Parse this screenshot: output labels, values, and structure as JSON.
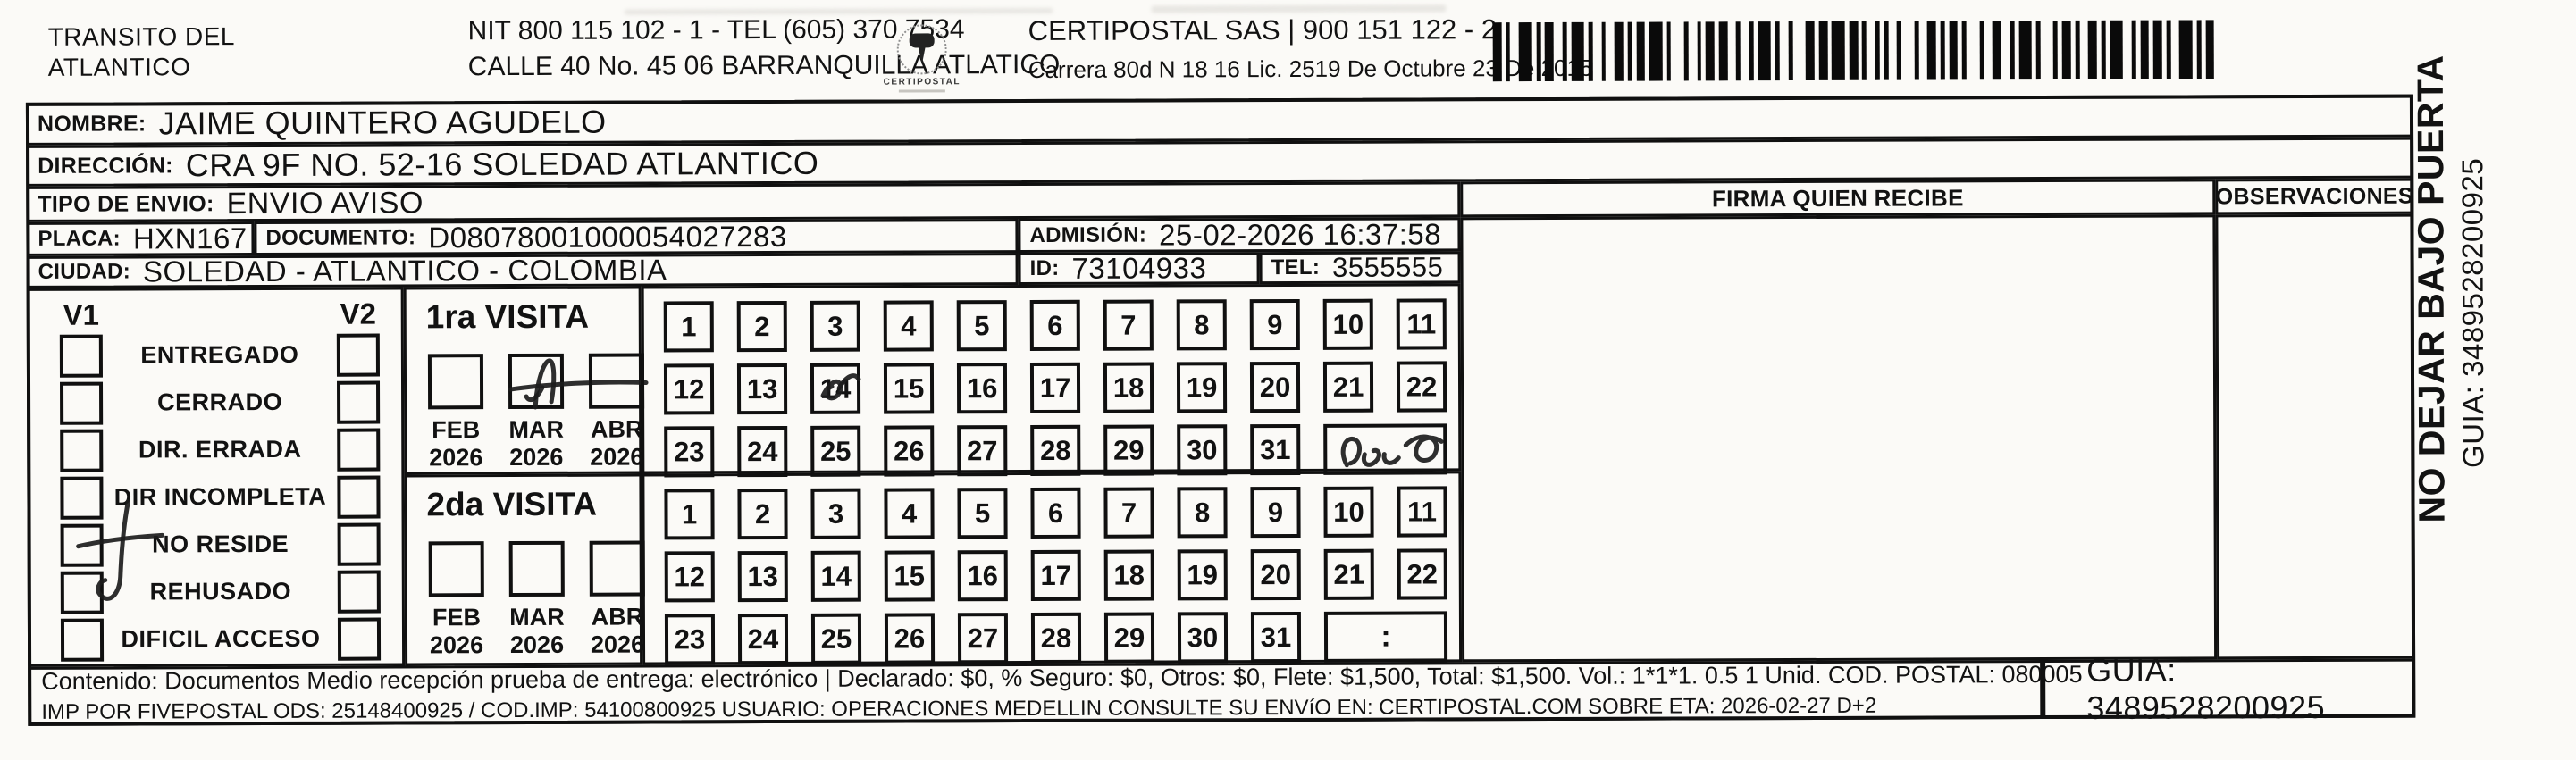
{
  "header": {
    "company_line1": "TRANSITO DEL",
    "company_line2": "ATLANTICO",
    "nit_line": "NIT 800 115 102 - 1 - TEL (605) 370 7534",
    "address_line": "CALLE 40 No. 45 06 BARRANQUILLA ATLATICO",
    "logo_caption": "CERTIPOSTAL",
    "certipostal_line": "CERTIPOSTAL SAS | 900 151 122 - 2",
    "certipostal_address": "Carrera 80d N 18 16  Lic. 2519 De Octubre 23 De 2015"
  },
  "recipient": {
    "nombre_label": "NOMBRE:",
    "nombre": "JAIME QUINTERO AGUDELO",
    "direccion_label": "DIRECCIÓN:",
    "direccion": "CRA 9F NO. 52-16 SOLEDAD ATLANTICO",
    "tipo_label": "TIPO DE ENVIO:",
    "tipo": "ENVIO AVISO",
    "placa_label": "PLACA:",
    "placa": "HXN167",
    "documento_label": "DOCUMENTO:",
    "documento": "D08078001000054027283",
    "admision_label": "ADMISIÓN:",
    "admision": "25-02-2026 16:37:58",
    "ciudad_label": "CIUDAD:",
    "ciudad": "SOLEDAD - ATLANTICO - COLOMBIA",
    "id_label": "ID:",
    "id": "73104933",
    "tel_label": "TEL:",
    "tel": "3555555"
  },
  "signature": {
    "firma_header": "FIRMA QUIEN RECIBE",
    "observaciones_header": "OBSERVACIONES"
  },
  "visits": {
    "v1_label": "V1",
    "v2_label": "V2",
    "status_options": [
      "ENTREGADO",
      "CERRADO",
      "DIR. ERRADA",
      "DIR INCOMPLETA",
      "NO RESIDE",
      "REHUSADO",
      "DIFICIL ACCESO"
    ],
    "first_visit_label": "1ra VISITA",
    "second_visit_label": "2da VISITA",
    "months": [
      {
        "month": "FEB",
        "year": "2026"
      },
      {
        "month": "MAR",
        "year": "2026"
      },
      {
        "month": "ABR",
        "year": "2026"
      }
    ],
    "days_row1": [
      1,
      2,
      3,
      4,
      5,
      6,
      7,
      8,
      9,
      10,
      11
    ],
    "days_row2": [
      12,
      13,
      14,
      15,
      16,
      17,
      18,
      19,
      20,
      21,
      22
    ],
    "days_row3": [
      23,
      24,
      25,
      26,
      27,
      28,
      29,
      30,
      31
    ],
    "time_placeholder": ":"
  },
  "handwriting": {
    "v1_status_marked": "NO RESIDE",
    "first_visit_month_marked": "MAR 2026",
    "first_visit_day_marked": "14",
    "first_visit_note": "illegible pen scribble"
  },
  "sidebar": {
    "warning": "NO DEJAR BAJO PUERTA",
    "guia": "GUIA: 3489528200925"
  },
  "footer": {
    "line1": "Contenido: Documentos Medio recepción prueba de entrega: electrónico | Declarado: $0, % Seguro: $0, Otros: $0, Flete: $1,500, Total: $1,500. Vol.: 1*1*1. 0.5  1 Unid. COD. POSTAL: 080005",
    "line2": "IMP POR FIVEPOSTAL ODS: 25148400925 / COD.IMP: 54100800925 USUARIO: OPERACIONES MEDELLIN CONSULTE SU ENVíO EN: CERTIPOSTAL.COM SOBRE ETA: 2026-02-27 D+2",
    "guia_box": "GUIA: 3489528200925"
  }
}
